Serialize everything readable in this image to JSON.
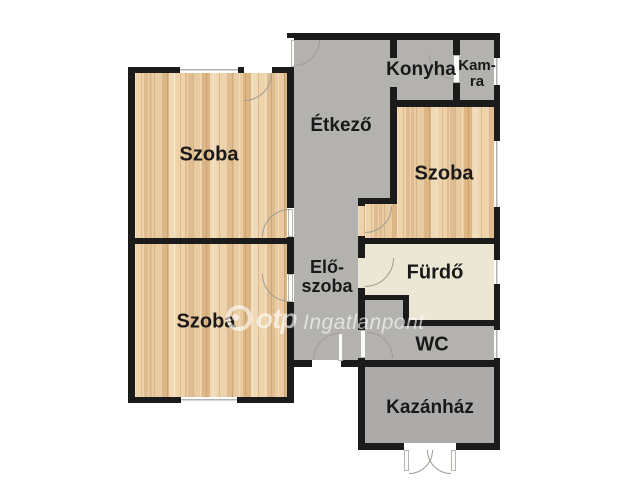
{
  "floorplan": {
    "rooms": {
      "szoba_top_left": "Szoba",
      "szoba_bottom_left": "Szoba",
      "szoba_right": "Szoba",
      "etkezo": "Étkező",
      "konyha": "Konyha",
      "kamra_line1": "Kam-",
      "kamra_line2": "ra",
      "eloszoba_line1": "Elő-",
      "eloszoba_line2": "szoba",
      "furdo": "Fürdő",
      "wc": "WC",
      "kazanhaz": "Kazánház"
    },
    "watermark": {
      "brand": "otp",
      "suffix": "Ingatlanpont"
    },
    "colors": {
      "wall": "#1b1b1b",
      "wood_floor": "#e8c99f",
      "tile_gray": "#b4b2af",
      "tile_gray_dark": "#adabaa",
      "tile_cream": "#ece6d5",
      "background": "#ffffff"
    }
  }
}
